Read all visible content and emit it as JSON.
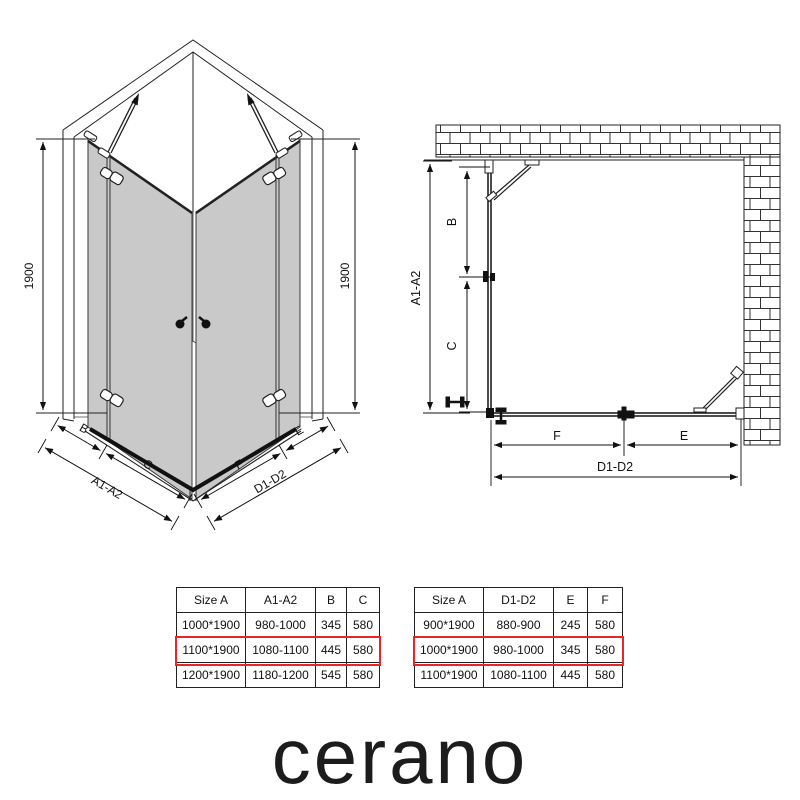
{
  "left_diagram": {
    "height_dim_left": "1900",
    "height_dim_right": "1900",
    "dims": {
      "b": "B",
      "c": "C",
      "a": "A1-A2",
      "f": "F",
      "e": "E",
      "d": "D1-D2"
    }
  },
  "right_diagram": {
    "dims": {
      "a": "A1-A2",
      "b": "B",
      "c": "C",
      "f": "F",
      "e": "E",
      "d": "D1-D2"
    }
  },
  "tables": [
    {
      "headers": [
        "Size A",
        "A1-A2",
        "B",
        "C"
      ],
      "rows": [
        [
          "1000*1900",
          "980-1000",
          "345",
          "580"
        ],
        [
          "1100*1900",
          "1080-1100",
          "445",
          "580"
        ],
        [
          "1200*1900",
          "1180-1200",
          "545",
          "580"
        ]
      ],
      "highlighted_row": 1
    },
    {
      "headers": [
        "Size A",
        "D1-D2",
        "E",
        "F"
      ],
      "rows": [
        [
          "900*1900",
          "880-900",
          "245",
          "580"
        ],
        [
          "1000*1900",
          "980-1000",
          "345",
          "580"
        ],
        [
          "1100*1900",
          "1080-1100",
          "445",
          "580"
        ]
      ],
      "highlighted_row": 1
    }
  ],
  "logo_text": "cerano",
  "colors": {
    "glass_fill": "#c9c9c9",
    "line": "#222222",
    "highlight_red": "#e8262a",
    "text": "#111111"
  }
}
